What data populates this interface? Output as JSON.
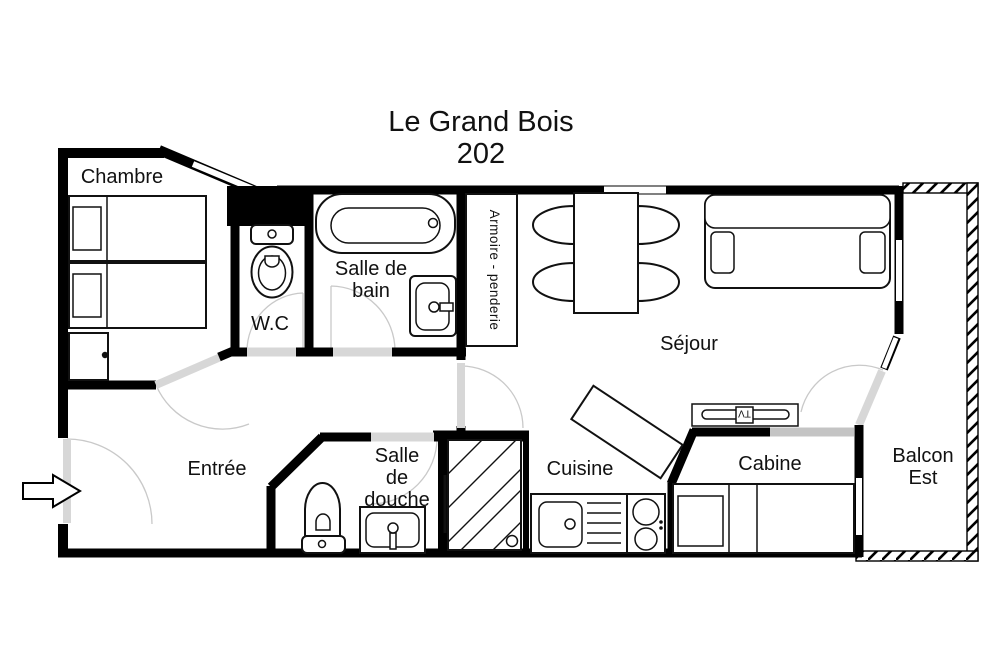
{
  "title": {
    "name": "Le Grand Bois",
    "unit": "202"
  },
  "rooms": {
    "chambre": {
      "label": "Chambre"
    },
    "wc": {
      "label": "W.C"
    },
    "salle_de_bain": {
      "line1": "Salle de",
      "line2": "bain"
    },
    "armoire": {
      "label": "Armoire - penderie"
    },
    "sejour": {
      "label": "Séjour"
    },
    "entree": {
      "label": "Entrée"
    },
    "salle_de_douche": {
      "line1": "Salle",
      "line2": "de",
      "line3": "douche"
    },
    "cuisine": {
      "label": "Cuisine"
    },
    "cabine": {
      "label": "Cabine"
    },
    "balcon_est": {
      "line1": "Balcon",
      "line2": "Est"
    }
  },
  "furniture": {
    "tv_label": "TV"
  },
  "colors": {
    "wall": "#000000",
    "furniture_line": "#111111",
    "door_leaf": "#d7d7d7",
    "swing_arc": "#c9c9c9",
    "window": "#ffffff",
    "background": "#ffffff"
  }
}
